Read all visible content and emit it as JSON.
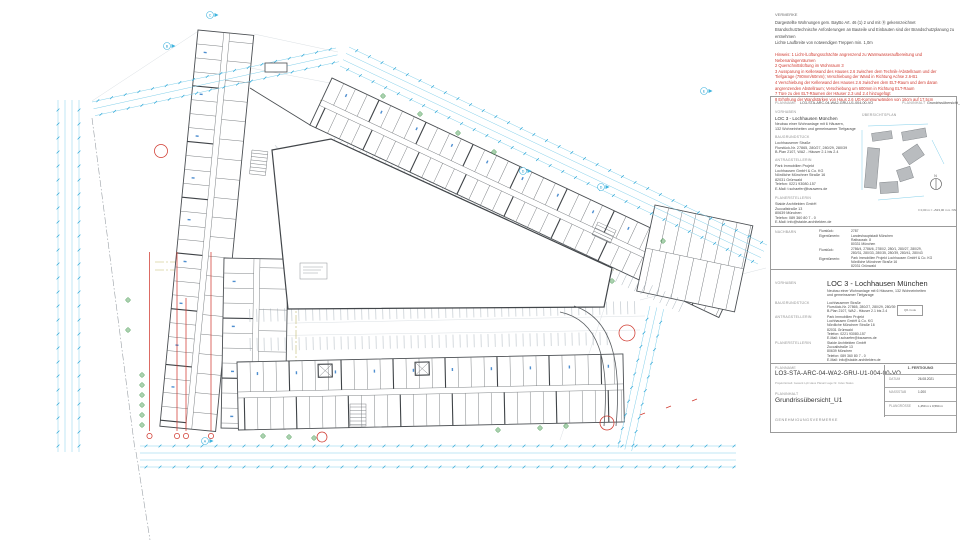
{
  "notes": {
    "heading": "VERMERKE",
    "general": [
      "Dargestellte Wohnungen gem. BayBo Art. 46 (1) 2 und mit Ⓡ gekennzeichnet",
      "Brandschutztechnische Anforderungen an Bauteile und Einbauten sind der Brandschutzplanung zu entnehmen",
      "Lichte Laufbreite von notwendigen Treppen min. 1,0m"
    ],
    "revisions": [
      "Hinweis:  1 Licht-/Lüftungsschächte angrenzend zu Warmwasseraufbereitung und Nebenanlagenräumen",
      "2 Querschnittslüftung im Wohnraum 3",
      "3 Aussparung in Kellerwand des Hauses 2.6 zwischen dem Technik-/Abstellraum und der",
      "   Tiefgarage (780mm/60mm); Verschiebung der Wand in Richtung Achse 2.6-B1",
      "4 Verschiebung der Kellerwand des Hauses 2.6 zwischen dem ELT-Raum und dem daran",
      "   angrenzenden Abstellraum; Verschiebung um 600mm in Richtung ELT-Raum",
      "7 Türe zu den ELT-Räumen der Häuser 2.3 und 2.4 hinzugefügt",
      "8 Erhöhung der Wandstärken von Haus 2.6 UG-Kommunwänden von 16cm auf 17,5cm"
    ]
  },
  "ref_row": {
    "planname_label": "PLANNAME",
    "planname": "LO3-STA-ARC-04-WA2-GRU-U1-004-00-VO",
    "planinhalt_label": "PLANINHALT",
    "planinhalt": "Grundrissübersicht_U1"
  },
  "project_small": {
    "vorhaben_label": "VORHABEN",
    "vorhaben_title": "LOC 3 - Lochhausen München",
    "vorhaben_desc": [
      "Neubau einer Wohnanlage mit 6 Häusern,",
      "132 Wohneinheiten und gemeinsamer Tiefgarage"
    ],
    "grundstueck_label": "BAUGRUNDSTÜCK",
    "grundstueck": [
      "Lochhausener Straße",
      "Flurstück-Nr. 27865, 280/27, 280/29, 280/39",
      "B-Plan 2107, WA2 - Häuser 2.1 bis 2.4"
    ],
    "antragstellerin_label": "ANTRAGSTELLERIN",
    "antragstellerin": [
      "Park Immobilien Projekt",
      "Lochhausen GmbH & Co. KG",
      "Nördliche Münchner Straße 16",
      "82031 Grünwald",
      "Telefon: 0221 93080-157",
      "E-Mail: t.schaefer@bauwens.de"
    ],
    "planerstellerin_label": "PLANERSTELLERIN",
    "planerstellerin": [
      "Staide Architekten GmbH",
      "Zuccalistraße 13",
      "80639 München",
      "Telefon: 089 360 80 7 - 0",
      "E-Mail: info@staide-architekten.de"
    ]
  },
  "overview": {
    "heading": "ÜBERSICHTSPLAN",
    "caption": "± 0,00 m = +523,00 m ü. NN",
    "north_label": "N"
  },
  "neighbors": {
    "heading": "NACHBARN",
    "flurstueck_label": "Flurstück:",
    "eigentuemerin_label": "Eigentümerin:",
    "row1_flurstueck": "2787",
    "row1_eigentuemerin": [
      "Landeshauptstadt München",
      "Rathausstr. 8",
      "80331 München"
    ],
    "row2_flurstueck": [
      "2786/4, 2786/6, 2780/2, 280/1, 280/27, 280/29,",
      "280/31, 280/33, 280/35, 280/39, 280/41, 280/43"
    ],
    "row2_eigentuemerin": [
      "Park Immobilien Projekt Lochhausen GmbH & Co. KG",
      "Nördliche Münchner Straße 16",
      "82031 Grünwald"
    ]
  },
  "project_main": {
    "vorhaben_label": "VORHABEN",
    "vorhaben_title": "LOC 3  - Lochhausen München",
    "vorhaben_desc": [
      "Neubau einer Wohnanlage mit 6 Häusern, 132 Wohneinheiten",
      "und gemeinsamer Tiefgarage"
    ],
    "grundstueck_label": "BAUGRUNDSTÜCK",
    "grundstueck": [
      "Lochhausener Straße",
      "Flurstück-Nr. 27865, 280/27, 280/29, 280/39",
      "B-Plan 2107, WA2 - Häuser 2.1 bis 2.4"
    ],
    "qr_label": "QR-Code",
    "antragstellerin_label": "ANTRAGSTELLERIN",
    "antragstellerin": [
      "Park Immobilien Projekt",
      "Lochhausen GmbH & Co. KG",
      "Nördliche Münchner Straße 16",
      "82031 Grünwald",
      "Telefon: 0221 93080-157",
      "E-Mail: t.schaefer@bauwens.de"
    ],
    "planerstellerin_label": "PLANERSTELLERIN",
    "planerstellerin": [
      "Staide Architekten GmbH",
      "Zuccalistraße 13",
      "80639 München",
      "Telefon: 089 360 80 7 - 0",
      "E-Mail: info@staide-architekten.de"
    ]
  },
  "titleblock": {
    "planname_label": "PLANNAME",
    "planname": "LO3-STA-ARC-04-WA2-GRU-U1-004-00-VO",
    "planname_key": "Projekt   Erstell.   Gewerk   Lph   Haus   Planart   Lage   Nr.   Index   Status",
    "planinhalt_label": "PLANINHALT",
    "planinhalt": "Grundrissübersicht_U1",
    "issue_label": "1. FERTIGUNG",
    "datum_label": "DATUM",
    "datum": "26.08.2021",
    "massstab_label": "MASSSTAB",
    "massstab": "1:200",
    "plangroesse_label": "PLANGRÖSSE",
    "plangroesse": "1,450 m x 0,594 m",
    "genehmigung_label": "GENEHMIGUNGSVERMERKE"
  },
  "plan": {
    "marker_letters": [
      "C",
      "B",
      "E",
      "D",
      "D",
      "A"
    ]
  }
}
